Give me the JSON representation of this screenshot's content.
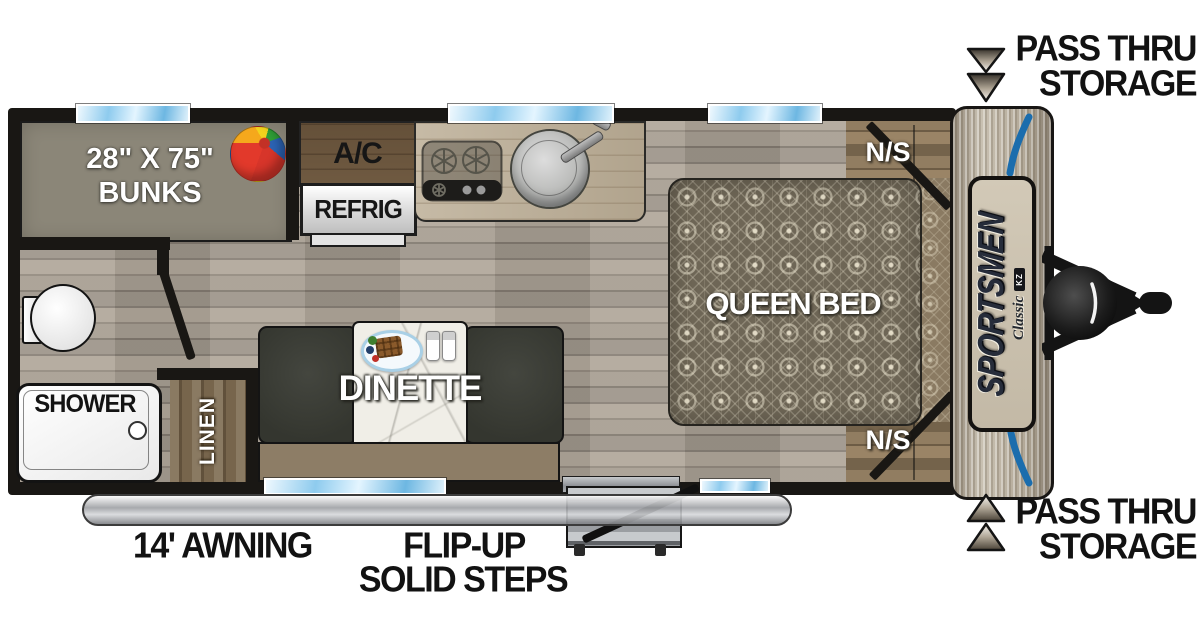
{
  "floorplan": {
    "bunks": {
      "line1": "28\" X 75\"",
      "line2": "BUNKS"
    },
    "ac": "A/C",
    "refrig": "REFRIG",
    "dinette": "DINETTE",
    "queen_bed": "QUEEN BED",
    "nightstand_top": "N/S",
    "nightstand_bottom": "N/S",
    "shower": "SHOWER",
    "linen": "LINEN"
  },
  "callouts": {
    "pass_thru_top": {
      "line1": "PASS THRU",
      "line2": "STORAGE"
    },
    "pass_thru_bottom": {
      "line1": "PASS THRU",
      "line2": "STORAGE"
    },
    "awning": "14' AWNING",
    "steps": {
      "line1": "FLIP-UP",
      "line2": "SOLID STEPS"
    }
  },
  "branding": {
    "model": "SPORTSMEN",
    "series": "Classic",
    "maker": "KZ"
  },
  "colors": {
    "wall": "#191714",
    "floor_gray": "#a19a8e",
    "accent_blue": "#1b6dad",
    "window_blue": "#8ecbee",
    "bunk_gray": "#8b8678",
    "bench_dark": "#3b3d38",
    "wood_brown": "#77654c",
    "cap_tan": "#bdb3a1",
    "bed_base": "#6e6656"
  }
}
